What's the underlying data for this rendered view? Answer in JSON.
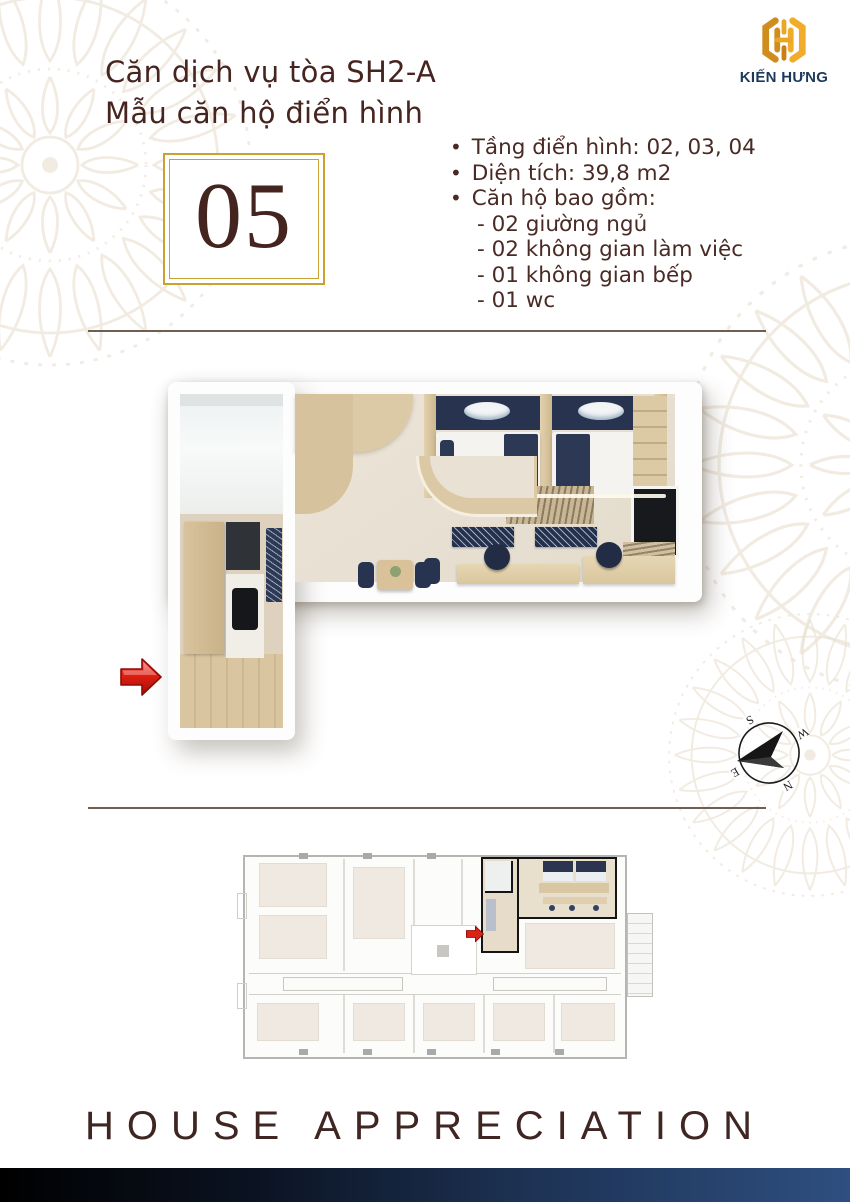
{
  "header": {
    "title_line1": "Căn dịch vụ tòa SH2-A",
    "title_line2": "Mẫu căn hộ điển hình",
    "brand_name": "KIẾN HƯNG"
  },
  "unit_badge": {
    "number": "05"
  },
  "specs": {
    "bullet": "•",
    "bullet_items": [
      "Tầng điển hình: 02, 03, 04",
      "Diện tích: 39,8 m2",
      "Căn hộ bao gồm:"
    ],
    "sub_items": [
      "- 02 giường ngủ",
      "- 02 không gian làm việc",
      "- 01 không gian bếp",
      "- 01 wc"
    ]
  },
  "compass": {
    "north": "N",
    "south": "S",
    "east": "E",
    "west": "W"
  },
  "footer": {
    "tagline": "HOUSE APPRECIATION"
  },
  "colors": {
    "title_maroon": "#46241F",
    "brand_navy": "#1D3A5C",
    "accent_gold": "#C9A233",
    "logo_gold": "#E8A826",
    "arrow_red": "#D62A1C",
    "bed_navy": "#2C3854",
    "footer_bar_left": "#000000",
    "footer_bar_right": "#2E4F80"
  },
  "icons": {
    "brand_logo": "kien-hung-monogram",
    "entrance_arrow": "red-arrow-right",
    "unit_locator_arrow": "red-arrow-right-small",
    "compass": "compass-rose"
  }
}
